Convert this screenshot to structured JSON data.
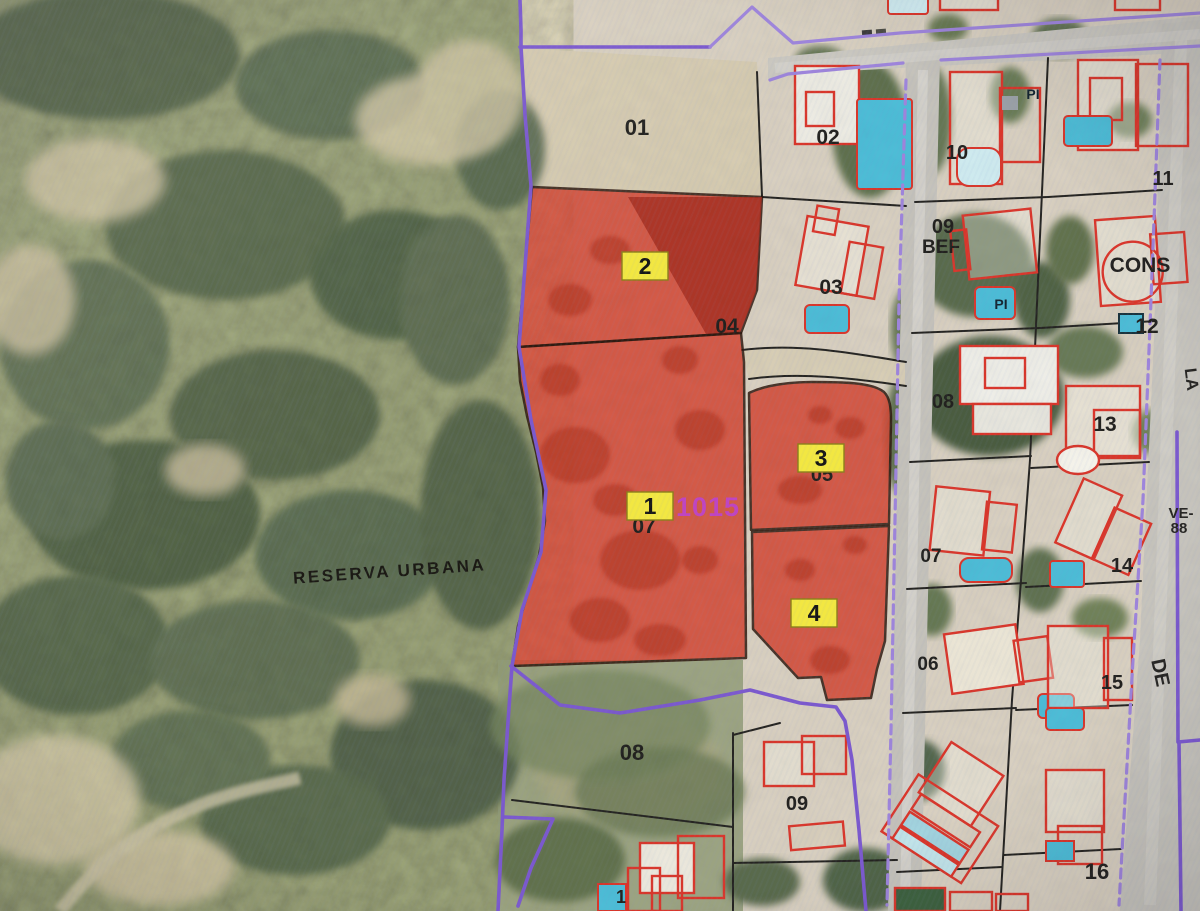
{
  "map": {
    "colors": {
      "selection_fill": "#d7402b",
      "selection_dark": "#a8281a",
      "badge_fill": "#f2e636",
      "badge_border": "#8a7d10",
      "boundary_purple": "#7a55d6",
      "road_edge_purple": "#9d82e2",
      "cadastral_red": "#e03125",
      "pool_blue": "#45bcdb",
      "code_magenta": "#c23fc4",
      "label_black": "#1f1d1a"
    },
    "area_label": {
      "text": "RESERVA URBANA",
      "x": 390,
      "y": 577,
      "rotate": -4
    },
    "selection_code": {
      "text": "31015",
      "x": 700,
      "y": 516
    },
    "selected_parcels": [
      {
        "badge": "1",
        "x": 650,
        "y": 506
      },
      {
        "badge": "2",
        "x": 645,
        "y": 266
      },
      {
        "badge": "3",
        "x": 821,
        "y": 458
      },
      {
        "badge": "4",
        "x": 814,
        "y": 613
      }
    ],
    "parcel_numbers": [
      {
        "text": "01",
        "x": 637,
        "y": 135,
        "size": 22
      },
      {
        "text": "02",
        "x": 828,
        "y": 144,
        "size": 21
      },
      {
        "text": "03",
        "x": 831,
        "y": 294,
        "size": 21
      },
      {
        "text": "04",
        "x": 727,
        "y": 333,
        "size": 21
      },
      {
        "text": "07",
        "x": 644,
        "y": 533,
        "size": 21,
        "color": "#3a140a"
      },
      {
        "text": "05",
        "x": 822,
        "y": 481,
        "size": 20,
        "color": "#541208"
      },
      {
        "text": "10",
        "x": 957,
        "y": 159,
        "size": 20
      },
      {
        "text": "11",
        "x": 1163,
        "y": 185,
        "size": 20
      },
      {
        "text": "09",
        "x": 943,
        "y": 233,
        "size": 20
      },
      {
        "text": "BEF",
        "x": 941,
        "y": 253,
        "size": 19
      },
      {
        "text": "CONS",
        "x": 1140,
        "y": 272,
        "size": 21
      },
      {
        "text": "12",
        "x": 1147,
        "y": 333,
        "size": 21
      },
      {
        "text": "08",
        "x": 943,
        "y": 408,
        "size": 20
      },
      {
        "text": "13",
        "x": 1105,
        "y": 431,
        "size": 21
      },
      {
        "text": "07",
        "x": 931,
        "y": 562,
        "size": 19
      },
      {
        "text": "14",
        "x": 1122,
        "y": 572,
        "size": 20
      },
      {
        "text": "06",
        "x": 928,
        "y": 670,
        "size": 19
      },
      {
        "text": "15",
        "x": 1112,
        "y": 689,
        "size": 20
      },
      {
        "text": "08",
        "x": 632,
        "y": 760,
        "size": 22
      },
      {
        "text": "09",
        "x": 797,
        "y": 810,
        "size": 20
      },
      {
        "text": "16",
        "x": 1097,
        "y": 879,
        "size": 22
      },
      {
        "text": "1",
        "x": 621,
        "y": 903,
        "size": 18
      }
    ],
    "pool_labels": [
      {
        "text": "PI",
        "x": 1033,
        "y": 99
      },
      {
        "text": "PI",
        "x": 1001,
        "y": 309
      }
    ],
    "road_labels": [
      {
        "text": "LA",
        "x": 1186,
        "y": 380,
        "rotate": 83,
        "size": 17
      },
      {
        "text": "VE-",
        "x": 1181,
        "y": 518,
        "rotate": 0,
        "size": 15
      },
      {
        "text": "88",
        "x": 1179,
        "y": 533,
        "rotate": 0,
        "size": 15
      },
      {
        "text": "DE",
        "x": 1154,
        "y": 674,
        "rotate": 78,
        "size": 20
      }
    ]
  }
}
